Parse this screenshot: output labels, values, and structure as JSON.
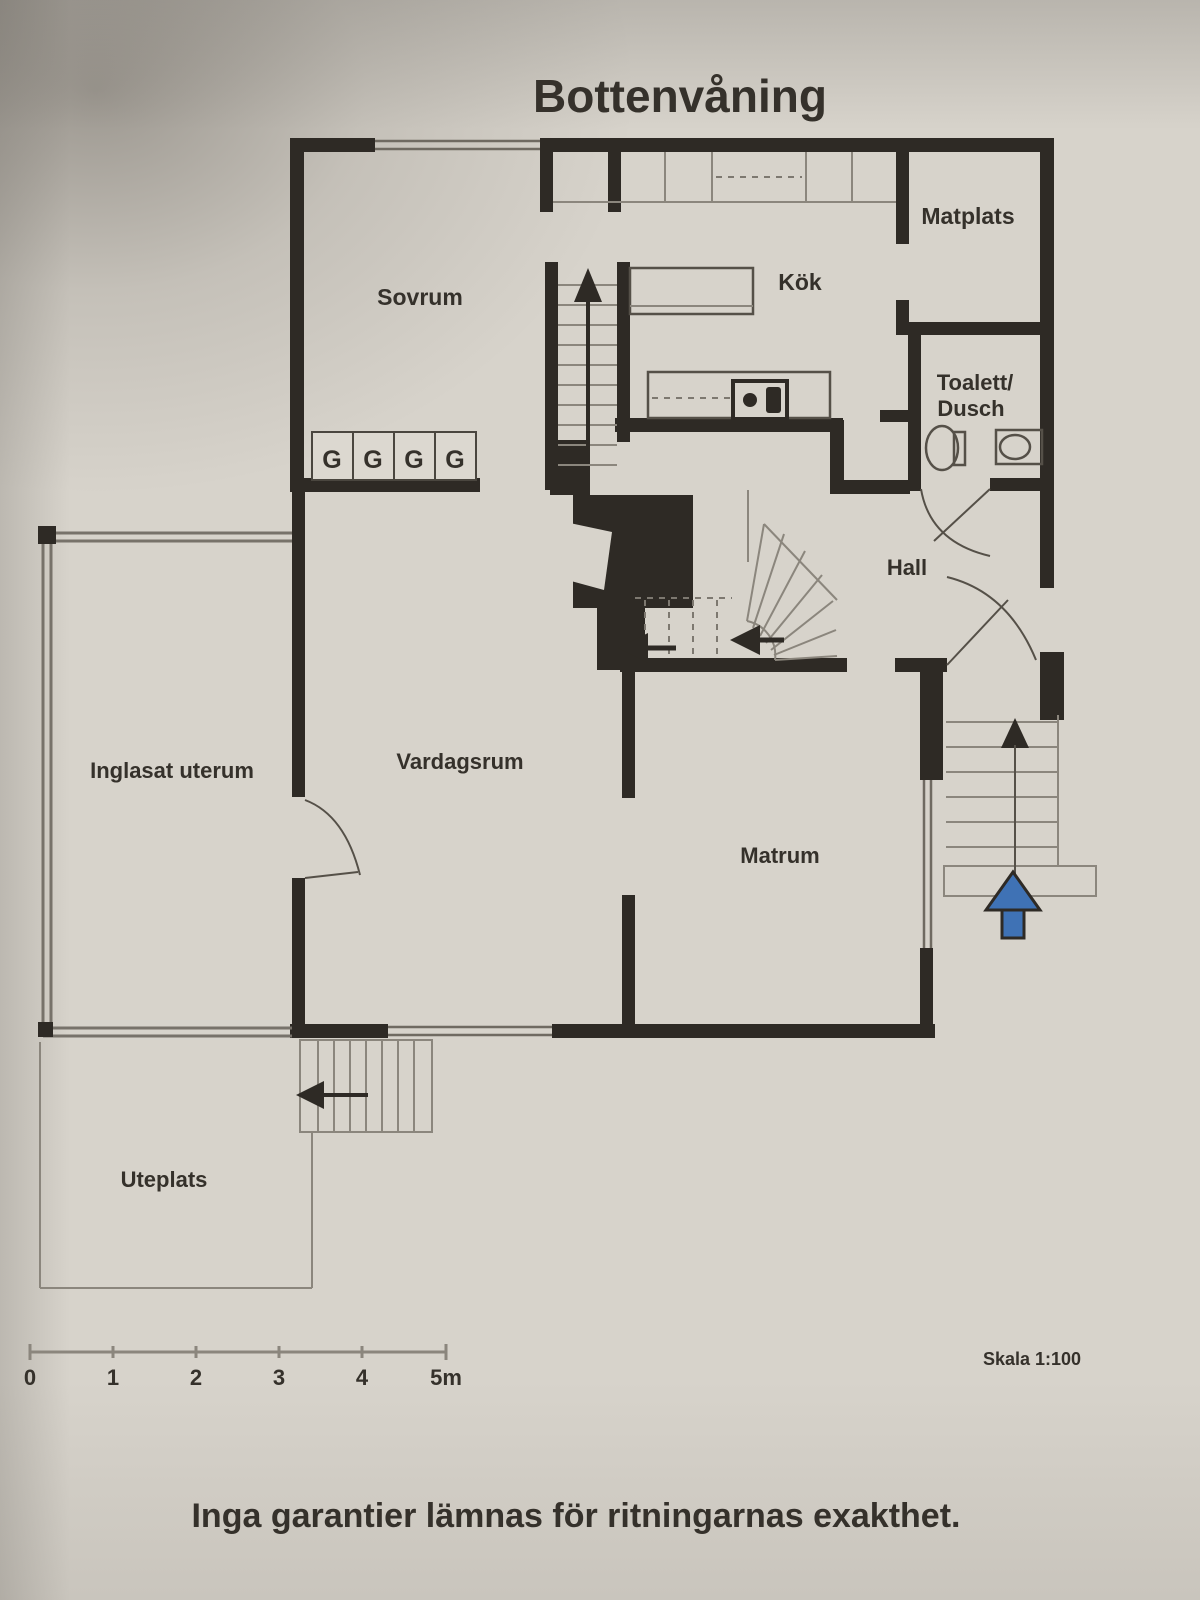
{
  "title": "Bottenvåning",
  "rooms": {
    "matplats": "Matplats",
    "kok": "Kök",
    "sovrum": "Sovrum",
    "toalett_line1": "Toalett/",
    "toalett_line2": "Dusch",
    "hall": "Hall",
    "inglasat_uterum": "Inglasat uterum",
    "vardagsrum": "Vardagsrum",
    "matrum": "Matrum",
    "uteplats": "Uteplats"
  },
  "wardrobe": {
    "labels": [
      "G",
      "G",
      "G",
      "G"
    ]
  },
  "scale_bar": {
    "ticks": [
      "0",
      "1",
      "2",
      "3",
      "4",
      "5m"
    ]
  },
  "scale_label": "Skala 1:100",
  "disclaimer": "Inga garantier lämnas för ritningarnas exakthet.",
  "colors": {
    "paper": "#d7d3cb",
    "wall": "#2e2a25",
    "thin_line": "#8b867d",
    "entry_arrow_blue": "#3f72b5"
  }
}
